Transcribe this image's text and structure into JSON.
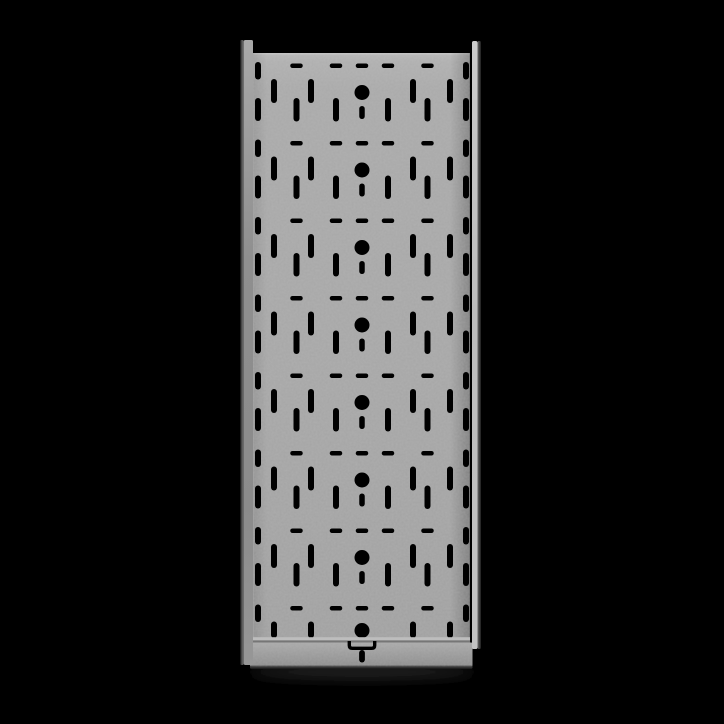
{
  "scene": {
    "width": 724,
    "height": 724,
    "background": "#000000",
    "object": "perforated-steel-cable-tray-top-view"
  },
  "colors": {
    "hole": "#000000",
    "base_gradient": [
      [
        "0%",
        "#b8b8b8"
      ],
      [
        "1.5%",
        "#afafaf"
      ],
      [
        "6%",
        "#a9a9a9"
      ],
      [
        "55%",
        "#a6a6a6"
      ],
      [
        "100%",
        "#a0a0a0"
      ]
    ],
    "top_edge_highlight": "#c6c6c6",
    "left_seam_highlight": "#b6b6b6",
    "left_inner_shade": "rgba(0,0,0,0.10)",
    "right_inner_shade": "rgba(0,0,0,0.22)",
    "left_edge_gradient": [
      [
        "0%",
        "#0d0d0d"
      ],
      [
        "45%",
        "#4f4f4f"
      ],
      [
        "100%",
        "#7a7a7a"
      ]
    ],
    "left_face_gradient": [
      [
        "0%",
        "#a9a9a9"
      ],
      [
        "35%",
        "#8f8f8f"
      ],
      [
        "75%",
        "#8b8b8b"
      ],
      [
        "100%",
        "#979797"
      ]
    ],
    "right_face_gradient": [
      [
        "0%",
        "#cccccc"
      ],
      [
        "45%",
        "#bcbcbc"
      ],
      [
        "100%",
        "#c3c3c3"
      ]
    ],
    "right_edge_gradient": [
      [
        "0%",
        "#6b6b6b"
      ],
      [
        "60%",
        "#3c3c3c"
      ],
      [
        "100%",
        "#1c1c1c"
      ]
    ],
    "fold_light": "#bdbdbd",
    "fold_dark": "#767676",
    "plate_gradient": [
      [
        "0%",
        "#aaaaaa"
      ],
      [
        "50%",
        "#9b9b9b"
      ],
      [
        "100%",
        "#8d8d8d"
      ]
    ],
    "plate_edge_gradient": [
      [
        "0%",
        "#575757"
      ],
      [
        "100%",
        "#141414"
      ]
    ],
    "grain_gray": "#9e9e9e",
    "shadow": "#242424"
  },
  "geometry": {
    "center_x": 362,
    "base": {
      "x": 253,
      "y": 53,
      "w": 217,
      "h": 588
    },
    "left_wall": {
      "edge_x": 240,
      "edge_w": 3.8,
      "face_x": 243.8,
      "face_w": 9.2,
      "top": 40,
      "bottom": 665
    },
    "right_wall": {
      "face_x": 472,
      "face_w": 5.5,
      "edge_x": 477.5,
      "edge_w": 3.5,
      "top": 41,
      "bottom": 649
    },
    "crease": {
      "x": 469.3,
      "w": 2.9
    },
    "fold": {
      "x": 253,
      "w": 217,
      "light_y": 637.2,
      "light_h": 3.2,
      "dark_y": 640.4,
      "dark_h": 2.2
    },
    "end_plate": {
      "x": 250,
      "y": 642.5,
      "w": 222.5,
      "h": 24,
      "edge_h": 3.5
    },
    "shadow": {
      "cx": 362,
      "cy": 672,
      "rx": 112,
      "ry": 7
    }
  },
  "pattern": {
    "period": 77.5,
    "start_y": 58,
    "rows": 8,
    "clip_y": 638,
    "dash": {
      "w": 12.5,
      "h": 4.5,
      "rel_y": 5.5,
      "rx": 2.25,
      "offsets": [
        -65.5,
        -26,
        0,
        26,
        65.5
      ]
    },
    "edge_slot_upper": {
      "w": 6,
      "h": 17.5,
      "rel_y": 4,
      "rx": 3,
      "offsets": [
        -104,
        104
      ]
    },
    "edge_slot_lower": {
      "w": 6,
      "h": 23,
      "rel_y": 40,
      "rx": 3,
      "offsets": [
        -104,
        104
      ]
    },
    "inner_slot_upper": {
      "w": 6,
      "h": 24,
      "rel_y": 21,
      "rx": 3,
      "offsets": [
        -88,
        -51,
        51,
        88
      ]
    },
    "inner_slot_lower": {
      "w": 6,
      "h": 23.5,
      "rel_y": 40,
      "rx": 3,
      "offsets": [
        -65.5,
        -26,
        26,
        65.5
      ]
    },
    "center_circle": {
      "r": 7.5,
      "rel_y": 34.5,
      "last_row_cy": 630.5
    },
    "center_tick": {
      "w": 5.5,
      "h": 13,
      "rel_y": 48,
      "rx": 2.75
    }
  },
  "tab": {
    "cx": 362,
    "half_w": 12.7,
    "top_y": 641,
    "bottom_y": 648.3,
    "corner_r": 3.1,
    "stroke_w": 3.4,
    "slit": {
      "w": 5.8,
      "h": 12.5,
      "y": 650,
      "rx": 2.9
    }
  }
}
